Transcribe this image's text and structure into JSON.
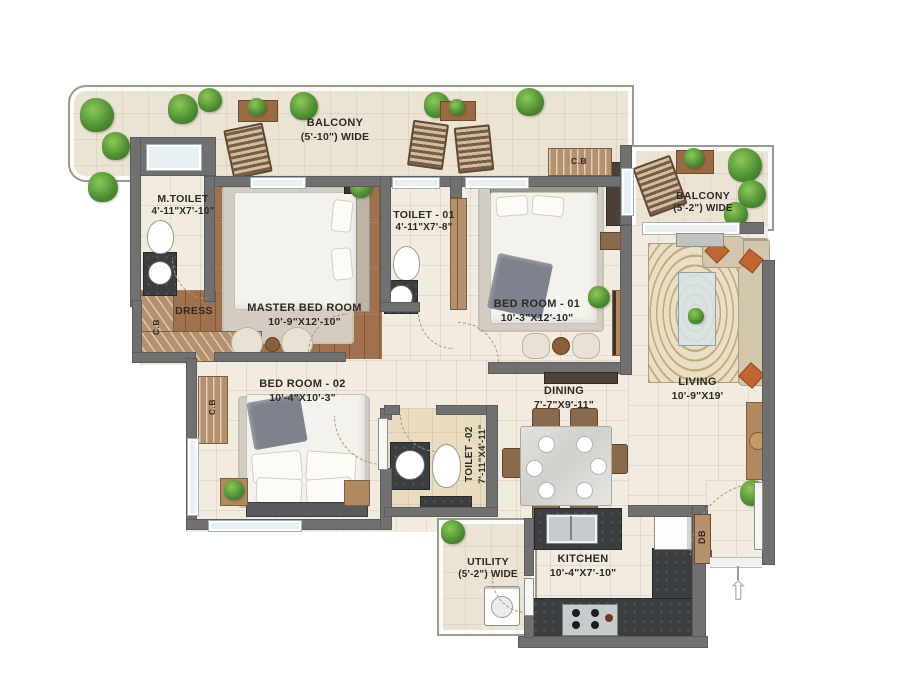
{
  "plan": {
    "type": "apartment-floor-plan",
    "rooms": {
      "balcony_top": {
        "name": "BALCONY",
        "dim": "(5'-10\") WIDE"
      },
      "m_toilet": {
        "name": "M.TOILET",
        "dim": "4'-11\"X7'-10\""
      },
      "master_bedroom": {
        "name": "MASTER BED ROOM",
        "dim": "10'-9\"X12'-10\""
      },
      "toilet_01": {
        "name": "TOILET - 01",
        "dim": "4'-11\"X7'-8\""
      },
      "bedroom_01": {
        "name": "BED ROOM - 01",
        "dim": "10'-3\"X12'-10\""
      },
      "balcony_right": {
        "name": "BALCONY",
        "dim": "(5'-2\") WIDE"
      },
      "dress": {
        "name": "DRESS"
      },
      "bedroom_02": {
        "name": "BED ROOM - 02",
        "dim": "10'-4\"X10'-3\""
      },
      "dining": {
        "name": "DINING",
        "dim": "7'-7\"X9'-11\""
      },
      "living": {
        "name": "LIVING",
        "dim": "10'-9\"X19'"
      },
      "toilet_02": {
        "name": "TOILET -02",
        "dim": "7'-11\"X4'-11\""
      },
      "utility": {
        "name": "UTILITY",
        "dim": "(5'-2\") WIDE"
      },
      "kitchen": {
        "name": "KITCHEN",
        "dim": "10'-4\"X7'-10\""
      }
    },
    "labels": {
      "cb_bedroom01": "C.B",
      "cb_dress": "C.B",
      "cb_bedroom02": "C.B",
      "db": "DB",
      "entry_arrow": "⇧"
    },
    "colors": {
      "wall": "#707070",
      "floor_tile": "#f2ebdf",
      "wood_floor": "#a0714d",
      "counter_dark": "#3b3e41",
      "cabinet_wood": "#b4916c",
      "plant_green": "#4a8a30",
      "cushion_rust": "#c2662f"
    }
  }
}
